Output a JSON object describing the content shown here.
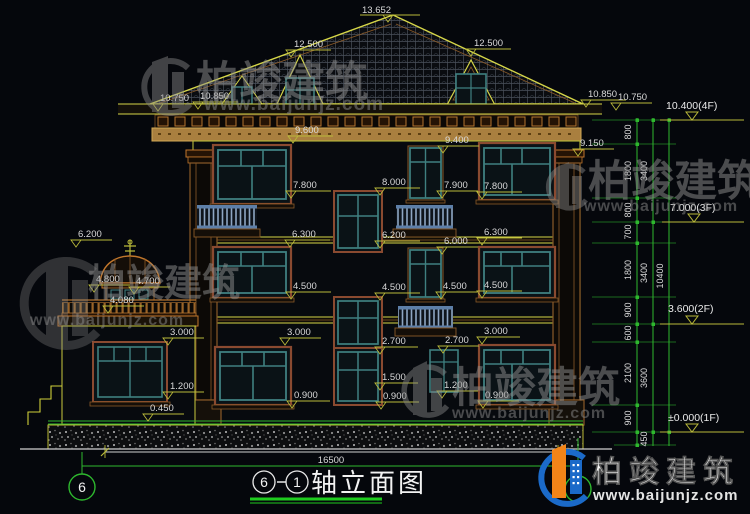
{
  "watermark": {
    "brand": "柏竣建筑",
    "url": "www.baijunjz.com"
  },
  "logo": {
    "brand": "柏竣建筑",
    "url": "www.baijunjz.com"
  },
  "title": {
    "axis_start": "6",
    "axis_end": "1",
    "name": "轴立面图"
  },
  "axis_bubbles": {
    "left": "6",
    "right": "1"
  },
  "dimensions": {
    "ridge": "13.652",
    "dormer_left": "12.500",
    "dormer_right": "12.500",
    "eave_left_outer": "10.750",
    "eave_left_inner": "10.850",
    "eave_right_inner": "10.850",
    "eave_right_outer": "10.750",
    "cornice_left": "9.600",
    "cornice_center": "9.400",
    "pilaster_right": "9.150",
    "win3_left_sill": "7.800",
    "stair3_head": "8.000",
    "win3_small_sill": "7.900",
    "win3_right_sill": "7.800",
    "floor3_left": "6.300",
    "stair3_sill": "6.200",
    "win2_small_head": "6.000",
    "floor3_right": "6.300",
    "win2_left_sill": "4.500",
    "win2_mid_sill": "4.500",
    "win2_small_sill": "4.500",
    "win2_right_sill": "4.500",
    "turret_finial": "6.200",
    "turret_roof": "4.800",
    "turret_eave": "4.700",
    "parapet": "4.080",
    "annex_win_head": "3.000",
    "win1_left_head": "3.000",
    "stair1_head": "2.700",
    "win1_small_head": "2.700",
    "win1_right_head": "3.000",
    "stair1_mid": "1.500",
    "annex_win_sill": "1.200",
    "win1_small_sill": "1.200",
    "win1_left_sill": "0.900",
    "stair1_sill": "0.900",
    "win1_right_sill": "0.900",
    "plinth_top": "0.450",
    "overall_width": "16500"
  },
  "right_chain": {
    "segments": [
      "800",
      "1800",
      "800",
      "700",
      "1800",
      "900",
      "600",
      "2100",
      "900"
    ],
    "floors": [
      "3400",
      "3400",
      "3600"
    ],
    "overall": "10400",
    "below_grade": "450",
    "levels": [
      "10.400(4F)",
      "7.000(3F)",
      "3.600(2F)",
      "±0.000(1F)"
    ]
  }
}
